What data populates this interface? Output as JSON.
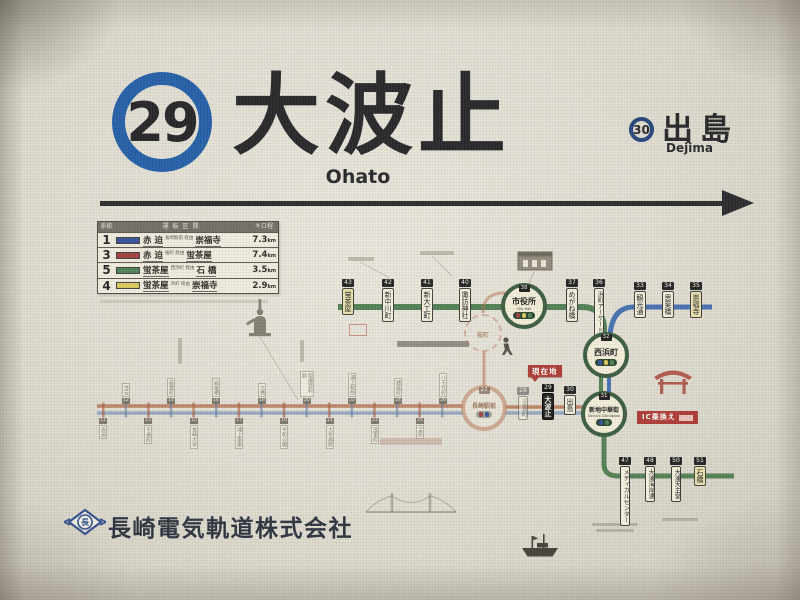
{
  "header": {
    "line_number": "29",
    "station_name": "大波止",
    "station_romaji": "Ohato",
    "next": {
      "number": "30",
      "name": "出島",
      "romaji": "Dejima"
    }
  },
  "legend": {
    "columns": {
      "route": "系統",
      "section": "運転区間",
      "distance": "キロ程"
    },
    "rows": [
      {
        "route": "1",
        "color": "#2e4d9b",
        "from": "赤 迫",
        "via": "長崎駅前 経由",
        "to": "崇福寺",
        "distance": "7.3",
        "unit": "km"
      },
      {
        "route": "3",
        "color": "#9e3a39",
        "from": "赤 迫",
        "via": "桜町 経由",
        "to": "蛍茶屋",
        "distance": "7.4",
        "unit": "km"
      },
      {
        "route": "5",
        "color": "#4a7d52",
        "from": "蛍茶屋",
        "via": "西浜町 経由",
        "to": "石 橋",
        "distance": "3.5",
        "unit": "km"
      },
      {
        "route": "4",
        "color": "#d8c85a",
        "from": "蛍茶屋",
        "via": "浜町 経由",
        "to": "崇福寺",
        "distance": "2.9",
        "unit": "km"
      }
    ]
  },
  "map": {
    "line_colors": {
      "green": "#4c7c50",
      "green_dark": "#37553b",
      "blue": "#3f6cae",
      "blue_dark": "#2e4f7a",
      "faded_red": "#b06a4a",
      "faded_blue": "#8099b8"
    },
    "markers": {
      "current": "現在地",
      "ic_transfer": "IC乗換え"
    },
    "green_line": [
      {
        "number": "43",
        "name": "蛍茶屋"
      },
      {
        "number": "42",
        "name": "新中川町"
      },
      {
        "number": "41",
        "name": "新大工町"
      },
      {
        "number": "40",
        "name": "諏訪神社"
      },
      {
        "number": "37",
        "name": "めがね橋"
      },
      {
        "number": "36",
        "name": "浜町アーケード"
      }
    ],
    "interchanges": {
      "shiyakusho": {
        "number": "38",
        "name": "市役所",
        "en": "City Hall"
      },
      "nishihamanomachi": {
        "number": "32",
        "name": "西浜町"
      },
      "shinchi": {
        "number": "31",
        "name": "新地中華街",
        "en": "Shinchi Chinatown"
      },
      "nagasaki_station": {
        "number": "27",
        "name": "長崎駅前"
      },
      "sakuramachi": {
        "name": "桜町"
      }
    },
    "blue_line": [
      {
        "number": "33",
        "name": "観光通"
      },
      {
        "number": "34",
        "name": "思案橋"
      },
      {
        "number": "35",
        "name": "崇福寺"
      }
    ],
    "harbor_line": [
      {
        "number": "28",
        "name": "五島町"
      },
      {
        "number": "29",
        "name": "大波止"
      },
      {
        "number": "30",
        "name": "出島"
      }
    ],
    "branch_line": [
      {
        "number": "47",
        "name": "メディカルセンター"
      },
      {
        "number": "48",
        "name": "大浦海岸通"
      },
      {
        "number": "50",
        "name": "大浦天主堂"
      },
      {
        "number": "51",
        "name": "石橋"
      }
    ],
    "north_line": [
      {
        "number": "11",
        "name": "赤迫"
      },
      {
        "number": "12",
        "name": "住吉"
      },
      {
        "number": "13",
        "name": "千歳町"
      },
      {
        "number": "14",
        "name": "若葉町"
      },
      {
        "number": "15",
        "name": "長崎大学"
      },
      {
        "number": "16",
        "name": "岩屋橋"
      },
      {
        "number": "17",
        "name": "浦上車庫"
      },
      {
        "number": "18",
        "name": "大橋"
      },
      {
        "number": "19",
        "name": "平和公園"
      },
      {
        "number": "20",
        "name": "原爆資料館"
      },
      {
        "number": "21",
        "name": "大学病院"
      },
      {
        "number": "22",
        "name": "浦上駅前"
      },
      {
        "number": "23",
        "name": "茂里町"
      },
      {
        "number": "24",
        "name": "銭座町"
      },
      {
        "number": "25",
        "name": "宝町"
      },
      {
        "number": "26",
        "name": "八千代町"
      }
    ]
  },
  "footer": {
    "logo_char": "長",
    "company": "長崎電気軌道株式会社"
  }
}
